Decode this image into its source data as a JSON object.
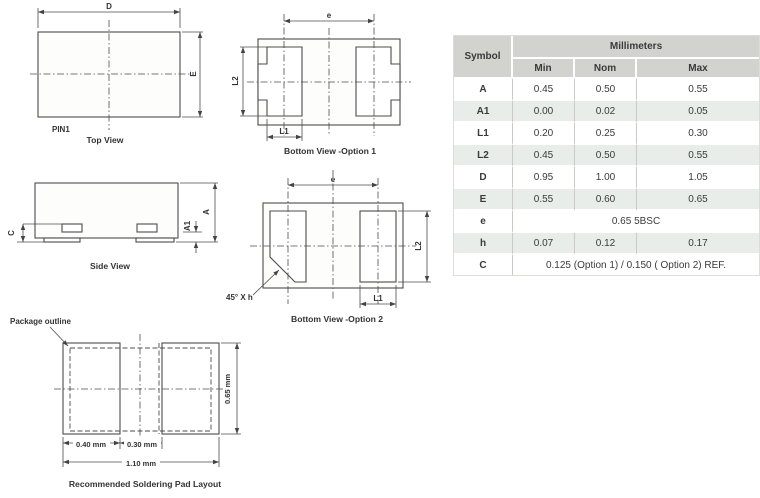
{
  "diagrams": {
    "top_view": {
      "title": "Top View",
      "pin1_label": "PIN1",
      "dim_d": "D",
      "dim_e": "E"
    },
    "bottom_view_option1": {
      "title": "Bottom View -Option 1",
      "dim_e": "e",
      "dim_l1": "L1",
      "dim_l2": "L2"
    },
    "side_view": {
      "title": "Side View",
      "dim_a": "A",
      "dim_a1": "A1",
      "dim_c": "C"
    },
    "bottom_view_option2": {
      "title": "Bottom View -Option 2",
      "dim_e": "e",
      "dim_l1": "L1",
      "dim_l2": "L2",
      "chamfer_note": "45° X h"
    },
    "pad_layout": {
      "title": "Recommended Soldering Pad Layout",
      "outline_label": "Package outline",
      "dim_pad_width": "0.40 mm",
      "dim_gap": "0.30 mm",
      "dim_total_width": "1.10 mm",
      "dim_height": "0.65 mm"
    }
  },
  "table": {
    "symbol_header": "Symbol",
    "units_header": "Millimeters",
    "columns": [
      "Min",
      "Nom",
      "Max"
    ],
    "rows": [
      {
        "symbol": "A",
        "min": "0.45",
        "nom": "0.50",
        "max": "0.55"
      },
      {
        "symbol": "A1",
        "min": "0.00",
        "nom": "0.02",
        "max": "0.05"
      },
      {
        "symbol": "L1",
        "min": "0.20",
        "nom": "0.25",
        "max": "0.30"
      },
      {
        "symbol": "L2",
        "min": "0.45",
        "nom": "0.50",
        "max": "0.55"
      },
      {
        "symbol": "D",
        "min": "0.95",
        "nom": "1.00",
        "max": "1.05"
      },
      {
        "symbol": "E",
        "min": "0.55",
        "nom": "0.60",
        "max": "0.65"
      },
      {
        "symbol": "e",
        "span": "0.65 5BSC"
      },
      {
        "symbol": "h",
        "min": "0.07",
        "nom": "0.12",
        "max": "0.17"
      },
      {
        "symbol": "C",
        "span": "0.125 (Option 1) / 0.150 ( Option 2) REF."
      }
    ],
    "colors": {
      "header_bg": "#d2d2cf",
      "row_alt_bg": "#e9ede9",
      "grid_line": "#c9c9c6",
      "text": "#3a3a3a",
      "drawing_line": "#4c4c4c"
    }
  }
}
